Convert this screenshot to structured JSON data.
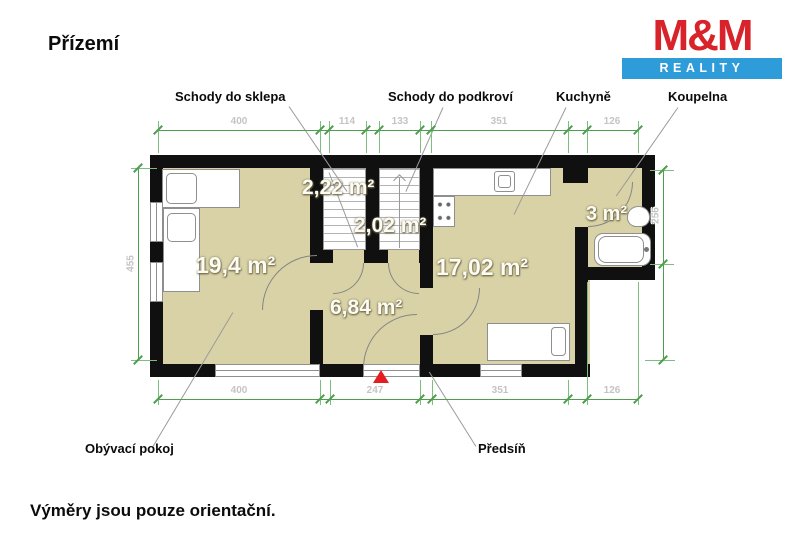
{
  "page": {
    "title": "Přízemí",
    "footer_note": "Výměry jsou pouze orientační."
  },
  "logo": {
    "name": "M&M",
    "subtitle": "REALITY",
    "red": "#d8232a",
    "blue": "#2e9cd9"
  },
  "rooms": {
    "living": {
      "label": "Obývací pokoj",
      "area": "19,4 m²"
    },
    "stairs_basement": {
      "label": "Schody do sklepa",
      "area": "2,22 m²"
    },
    "stairs_attic": {
      "label": "Schody do podkroví",
      "area": "2,02 m²"
    },
    "hallway": {
      "label": "Předsíň",
      "area": "6,84 m²"
    },
    "kitchen": {
      "label": "Kuchyně",
      "area": "17,02 m²"
    },
    "bathroom": {
      "label": "Koupelna",
      "area": "3 m²"
    }
  },
  "dimensions": {
    "top": [
      "400",
      "114",
      "133",
      "351",
      "126"
    ],
    "bottom": [
      "400",
      "247",
      "351",
      "126"
    ],
    "left": [
      "455"
    ],
    "right": [
      "256"
    ]
  },
  "symbols": {
    "entrance_marker": "red-triangle"
  },
  "colors": {
    "floor": "#d9d2a6",
    "wall": "#101010",
    "dimension_line": "#4f9e50",
    "entrance_marker": "#e41e20"
  }
}
